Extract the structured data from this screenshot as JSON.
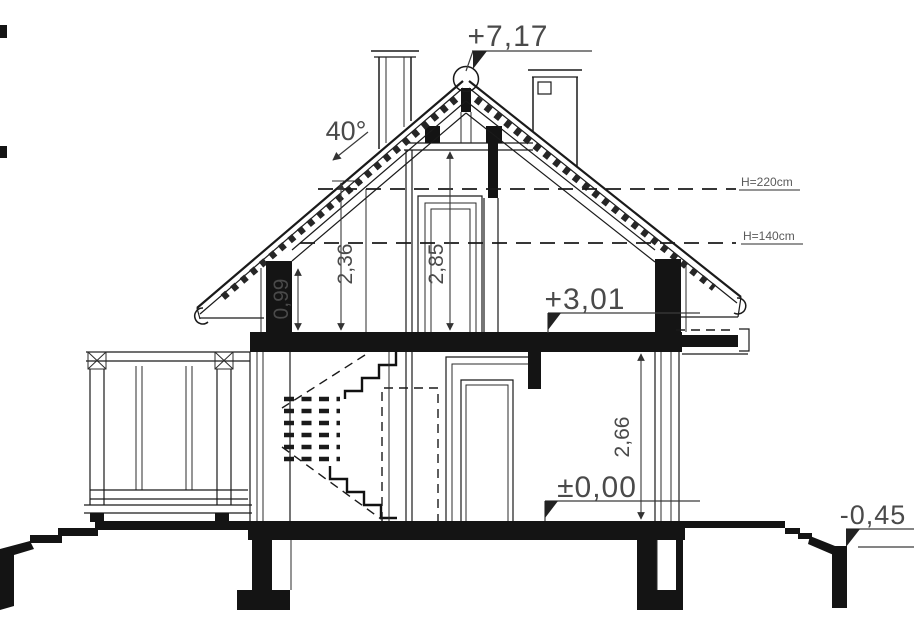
{
  "drawing": {
    "kind": "architectural cross-section",
    "labels": {
      "level_ridge": "+7,17",
      "roof_angle": "40°",
      "height_220": "H=220cm",
      "height_140": "H=140cm",
      "dim_knee_wall": "0,99",
      "dim_attic_236": "2,36",
      "dim_attic_285": "2,85",
      "level_attic_floor": "+3,01",
      "dim_ground_266": "2,66",
      "level_ground_floor": "±0,00",
      "level_site": "-0,45"
    },
    "colors": {
      "ink": "#1a1a1a",
      "text": "#4a4a4a",
      "background": "#ffffff"
    }
  }
}
